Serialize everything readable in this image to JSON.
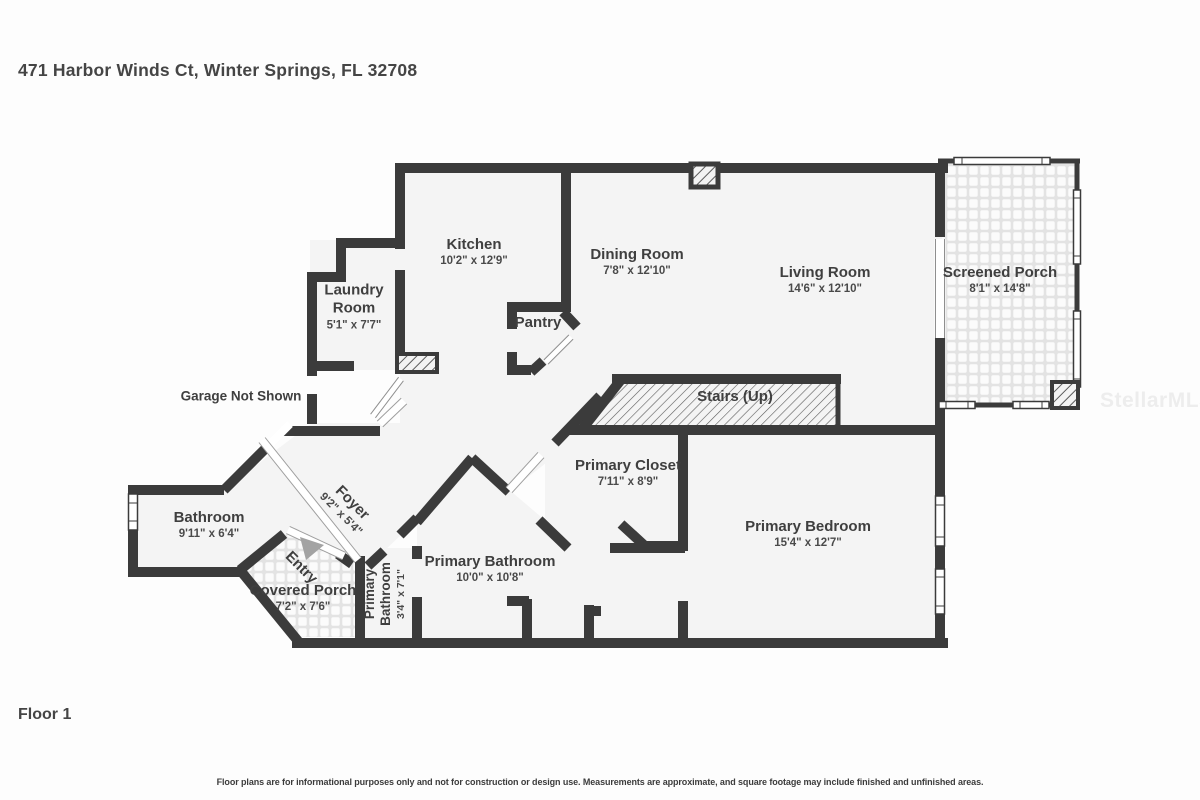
{
  "page": {
    "title": "471 Harbor Winds Ct, Winter Springs, FL 32708",
    "floor_label": "Floor 1",
    "disclaimer": "Floor plans are for informational purposes only and not for construction or design use. Measurements are approximate, and square footage may include finished and unfinished areas.",
    "watermark": "StellarMLS"
  },
  "colors": {
    "wall": "#3b3b3b",
    "floor": "#f4f4f4",
    "text": "#3f3f3f",
    "entry_arrow": "#a3a3a3"
  },
  "rooms": {
    "kitchen": {
      "name": "Kitchen",
      "dims": "10'2\" x 12'9\""
    },
    "dining": {
      "name": "Dining Room",
      "dims": "7'8\" x 12'10\""
    },
    "living": {
      "name": "Living Room",
      "dims": "14'6\" x 12'10\""
    },
    "screened_porch": {
      "name": "Screened Porch",
      "dims": "8'1\" x 14'8\""
    },
    "laundry": {
      "name": "Laundry Room",
      "dims": "5'1\" x 7'7\""
    },
    "pantry": {
      "name": "Pantry"
    },
    "stairs": {
      "name": "Stairs (Up)"
    },
    "primary_closet": {
      "name": "Primary Closet",
      "dims": "7'11\" x 8'9\""
    },
    "primary_bedroom": {
      "name": "Primary Bedroom",
      "dims": "15'4\" x 12'7\""
    },
    "bathroom": {
      "name": "Bathroom",
      "dims": "9'11\" x 6'4\""
    },
    "foyer": {
      "name": "Foyer",
      "dims": "9'2\" x 5'4\""
    },
    "entry": {
      "name": "Entry"
    },
    "covered_porch": {
      "name": "Covered Porch",
      "dims": "7'2\" x 7'6\""
    },
    "primary_bathroom": {
      "name": "Primary Bathroom",
      "dims": "10'0\" x 10'8\""
    },
    "primary_bathroom_small": {
      "name": "Primary Bathroom",
      "dims": "3'4\" x 7'1\""
    }
  },
  "notes": {
    "garage": "Garage Not Shown"
  }
}
